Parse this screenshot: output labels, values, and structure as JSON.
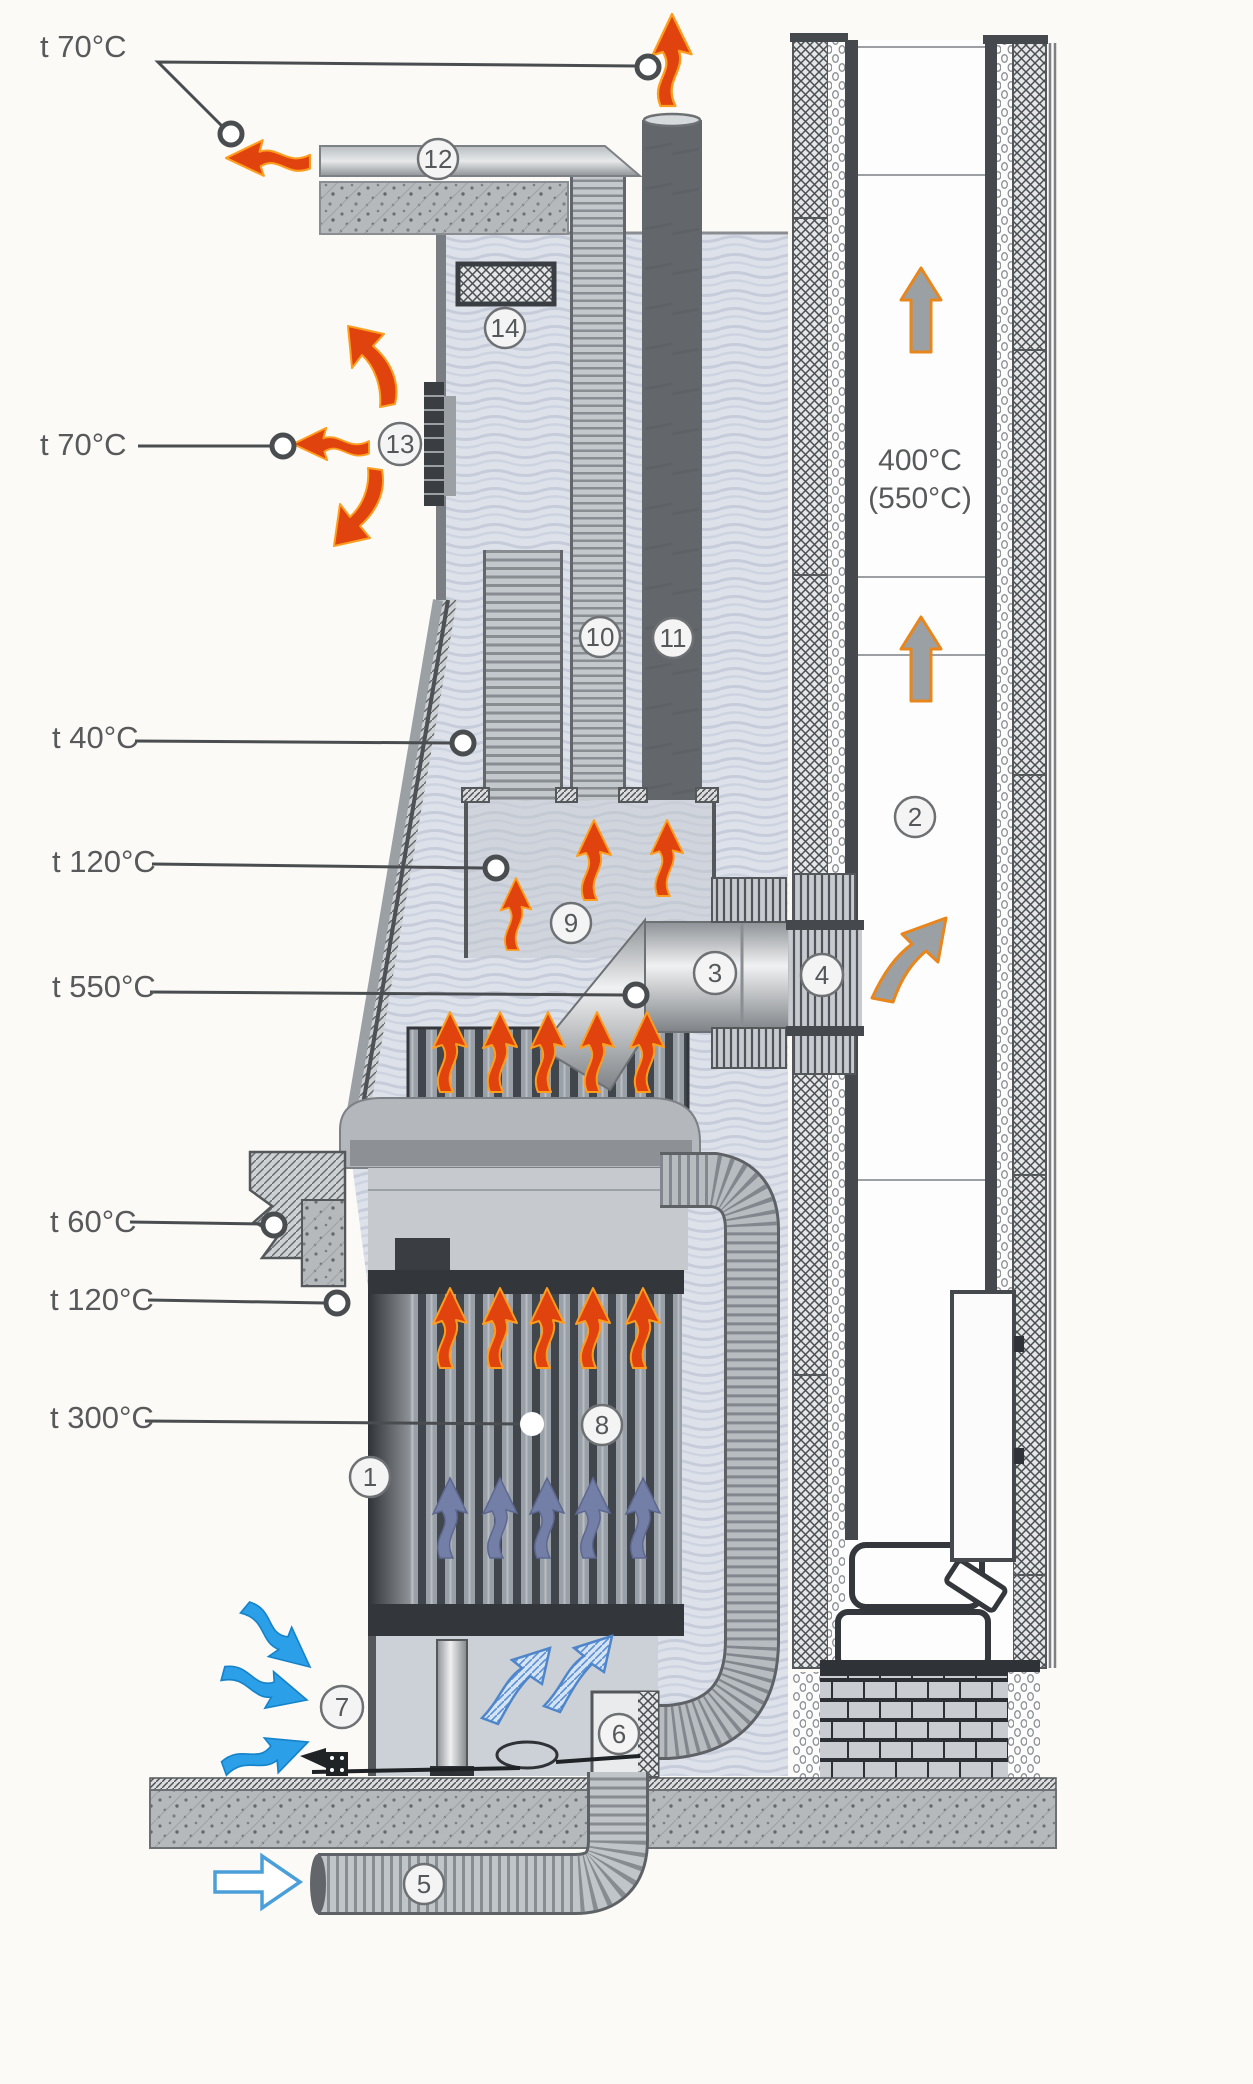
{
  "labels": {
    "t70_top": "t 70°C",
    "t70_grille": "t 70°C",
    "t40": "t 40°C",
    "t120_hood": "t 120°C",
    "t550": "t 550°C",
    "t60": "t 60°C",
    "t120_front": "t 120°C",
    "t300": "t 300°C",
    "flue_temp_line1": "400°C",
    "flue_temp_line2": "(550°C)"
  },
  "callouts": {
    "c1": "1",
    "c2": "2",
    "c3": "3",
    "c4": "4",
    "c5": "5",
    "c6": "6",
    "c7": "7",
    "c8": "8",
    "c9": "9",
    "c10": "10",
    "c11": "11",
    "c12": "12",
    "c13": "13",
    "c14": "14"
  },
  "colors": {
    "hot_air_arrow": "#e1430e",
    "cool_air_arrow": "#2ba0e8",
    "warm_return_arrow": "#747fa7",
    "flue_gas_arrow": "#9aa0a4",
    "label_text": "#57595b"
  }
}
